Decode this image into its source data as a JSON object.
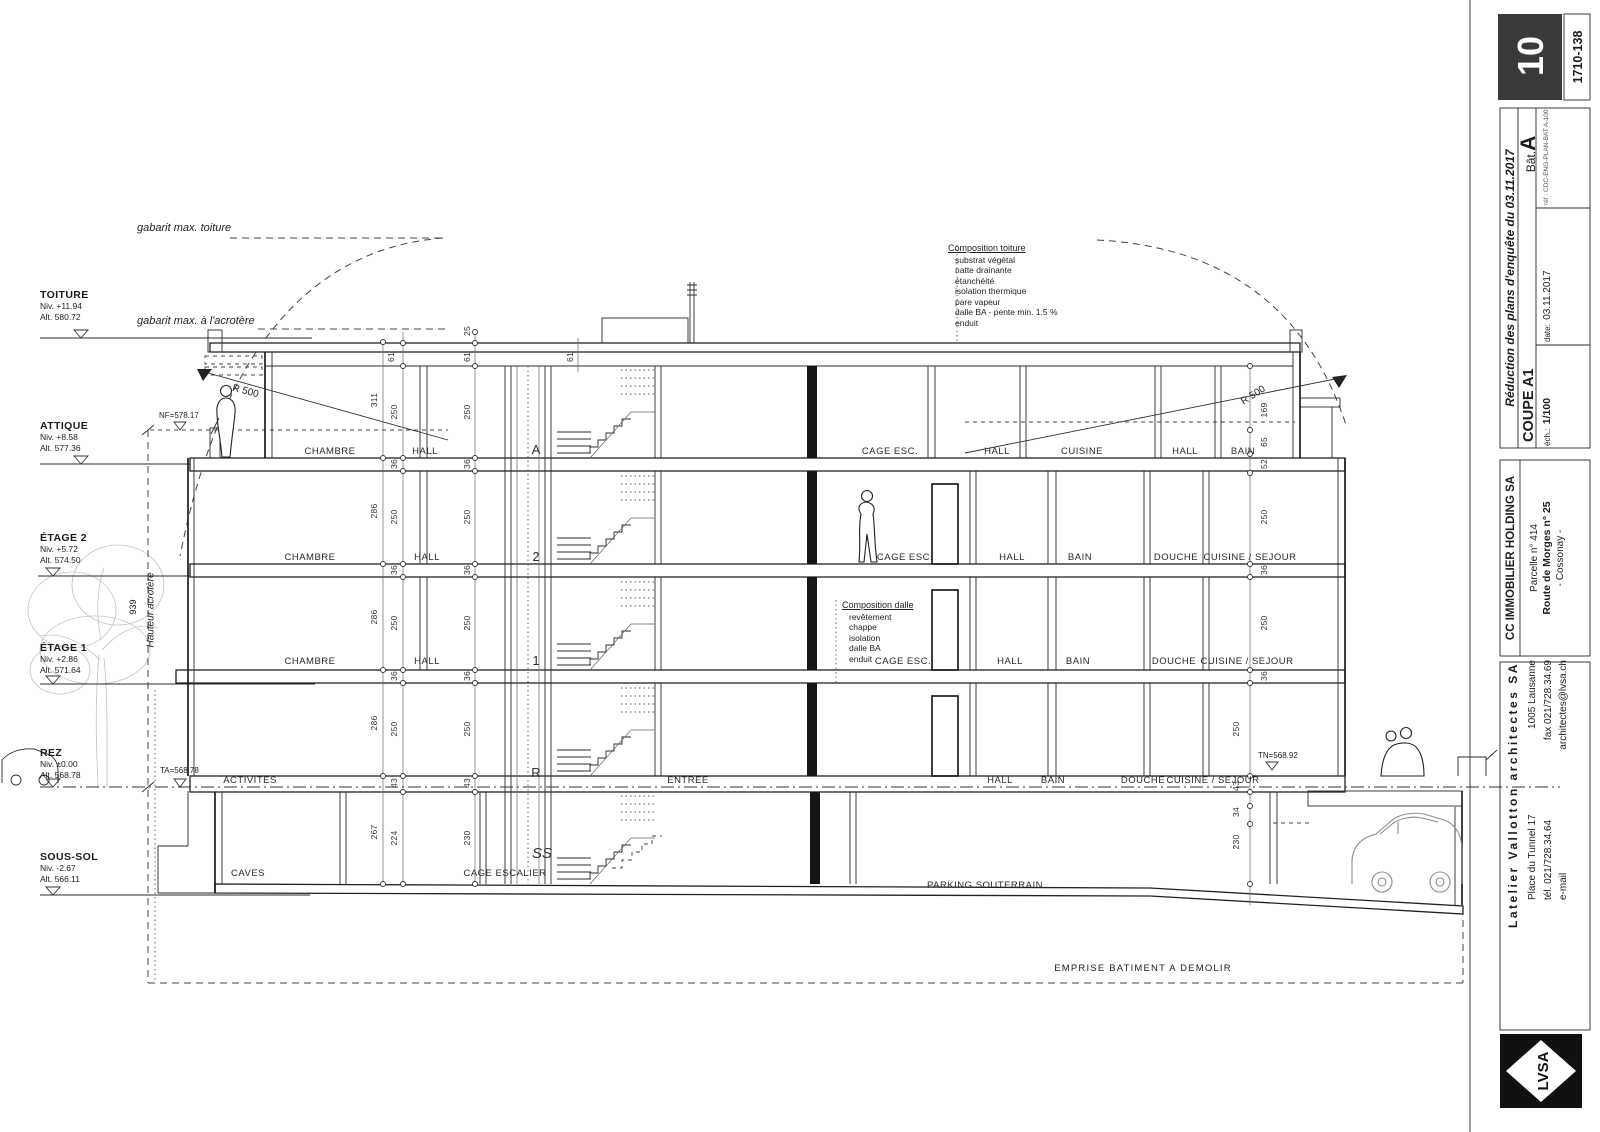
{
  "title_block": {
    "sheet_number": "10",
    "plan_number": "1710-138",
    "revision": "Réduction des plans d'enquête du 03.11.2017",
    "drawing_title": "COUPE A1",
    "scale_label": "éch.:",
    "scale_value": "1/100",
    "date_label": "date:",
    "date_value": "03.11.2017",
    "building_label": "Bât.",
    "building_value": "A",
    "ref": "réf : CDC-ENG-PLAN-BAT A-100",
    "client": {
      "name": "CC IMMOBILIER HOLDING SA",
      "parcel": "Parcelle n° 414",
      "street": "Route de Morges n° 25",
      "city": "- Cossonay -"
    },
    "architect": {
      "name": "Latelier Vallotton architectes SA",
      "address1": "Place du Tunnel 17",
      "address2": "1005 Lausanne",
      "tel": "tél. 021/728.34.64",
      "fax": "fax 021/728.34.69",
      "email_label": "e-mail",
      "email": "architectes@lvsa.ch",
      "logo": "LVSA"
    }
  },
  "levels": [
    {
      "name": "TOITURE",
      "niv": "Niv. +11.94",
      "alt": "Alt. 580.72"
    },
    {
      "name": "ATTIQUE",
      "niv": "Niv. +8.58",
      "alt": "Alt. 577.36"
    },
    {
      "name": "ÉTAGE 2",
      "niv": "Niv. +5.72",
      "alt": "Alt. 574.50"
    },
    {
      "name": "ÉTAGE 1",
      "niv": "Niv. +2.86",
      "alt": "Alt. 571.64"
    },
    {
      "name": "REZ",
      "niv": "Niv. ±0.00",
      "alt": "Alt. 568.78"
    },
    {
      "name": "SOUS-SOL",
      "niv": "Niv. -2.67",
      "alt": "Alt. 566.11"
    }
  ],
  "gabarit": {
    "toiture": "gabarit max. toiture",
    "acrotere": "gabarit max. à l'acrotère"
  },
  "height_marker": {
    "value": "939",
    "label": "Hauteur acrotère"
  },
  "spot_levels": {
    "nf": "NF=578.17",
    "ta": "TA=568.78",
    "tn": "TN=568.92"
  },
  "radius_label": "R 500",
  "compositions": {
    "toiture": {
      "title": "Composition toiture",
      "items": [
        "substrat végétal",
        "natte drainante",
        "étanchéité",
        "isolation thermique",
        "pare vapeur",
        "dalle BA - pente min. 1.5 %",
        "enduit"
      ]
    },
    "dalle": {
      "title": "Composition dalle",
      "items": [
        "revêtement",
        "chappe",
        "isolation",
        "dalle BA",
        "enduit"
      ]
    }
  },
  "floors": {
    "attique": {
      "letter": "A",
      "rooms": [
        "CHAMBRE",
        "HALL",
        "CAGE ESC.",
        "HALL",
        "CUISINE",
        "HALL",
        "BAIN"
      ]
    },
    "etage2": {
      "letter": "2",
      "rooms": [
        "CHAMBRE",
        "HALL",
        "CAGE ESC.",
        "HALL",
        "BAIN",
        "DOUCHE",
        "CUISINE / SEJOUR"
      ]
    },
    "etage1": {
      "letter": "1",
      "rooms": [
        "CHAMBRE",
        "HALL",
        "CAGE ESC.",
        "HALL",
        "BAIN",
        "DOUCHE",
        "CUISINE / SEJOUR"
      ]
    },
    "rez": {
      "letter": "R",
      "rooms": [
        "ACTIVITES",
        "ENTREE",
        "HALL",
        "BAIN",
        "DOUCHE",
        "CUISINE / SEJOUR"
      ]
    },
    "soussol": {
      "letter": "SS",
      "rooms": [
        "CAVES",
        "CAGE ESCALIER",
        "PARKING SOUTERRAIN"
      ]
    }
  },
  "dims": {
    "top": [
      "25",
      "61",
      "61",
      "61"
    ],
    "storey": [
      "311",
      "286",
      "286",
      "286",
      "267"
    ],
    "chain_b": [
      "250",
      "36",
      "250",
      "36",
      "250",
      "36",
      "250",
      "43",
      "224"
    ],
    "chain_c": [
      "250",
      "36",
      "250",
      "36",
      "250",
      "36",
      "250",
      "43",
      "230"
    ],
    "right_top": [
      "169",
      "65",
      "52"
    ],
    "right": [
      "250",
      "36",
      "250",
      "36",
      "250",
      "43",
      "34",
      "230"
    ]
  },
  "emprise": "EMPRISE BATIMENT A DEMOLIR"
}
